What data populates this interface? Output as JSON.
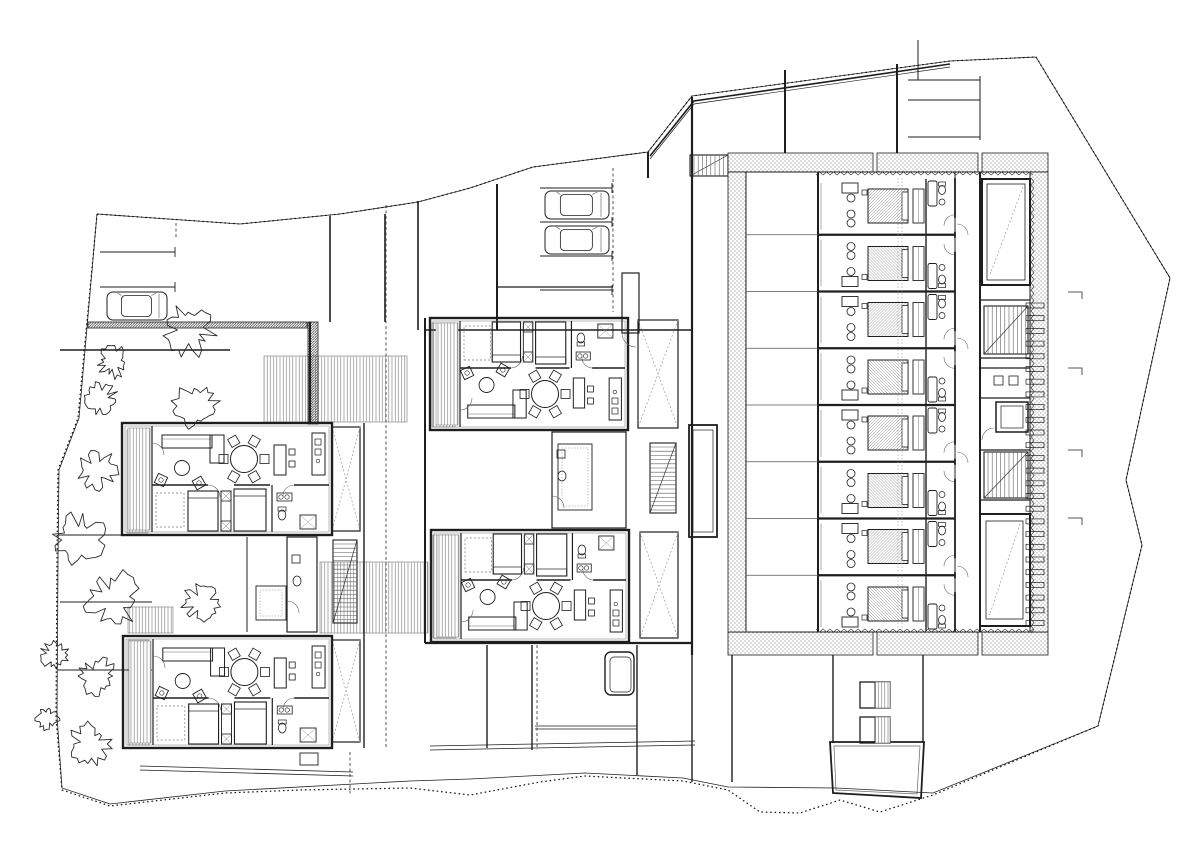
{
  "meta": {
    "title": "architectural ground-floor site plan",
    "drawing_type": "black and white CAD line drawing, no text labels",
    "canvas": {
      "w": 1200,
      "h": 848
    },
    "colors": {
      "ink": "#1e1e1e",
      "fine": "#555555",
      "paper": "#ffffff"
    }
  },
  "legend": {
    "hotel_room_modules": 8,
    "apartment_units": 4,
    "cars": 3,
    "trees": 12,
    "pools": 2,
    "stair_runs": 5,
    "stair_voids": 4
  },
  "boundary": {
    "dotted": [
      [
        97,
        214
      ],
      [
        240,
        224
      ],
      [
        340,
        214
      ],
      [
        418,
        202
      ],
      [
        470,
        188
      ],
      [
        533,
        167
      ],
      [
        648,
        152
      ],
      [
        692,
        96
      ],
      [
        950,
        61
      ],
      [
        1036,
        57
      ],
      [
        1170,
        278
      ],
      [
        1126,
        480
      ],
      [
        1142,
        545
      ],
      [
        1098,
        726
      ],
      [
        933,
        795
      ],
      [
        880,
        812
      ],
      [
        840,
        800
      ],
      [
        800,
        813
      ],
      [
        760,
        812
      ],
      [
        728,
        790
      ],
      [
        683,
        781
      ],
      [
        585,
        776
      ],
      [
        540,
        782
      ],
      [
        470,
        795
      ],
      [
        410,
        788
      ],
      [
        300,
        790
      ],
      [
        225,
        793
      ],
      [
        110,
        806
      ],
      [
        62,
        790
      ],
      [
        56,
        718
      ],
      [
        57,
        560
      ],
      [
        58,
        470
      ],
      [
        78,
        418
      ],
      [
        97,
        214
      ]
    ],
    "solid": [
      [
        97,
        214
      ],
      [
        240,
        224
      ],
      [
        340,
        214
      ],
      [
        418,
        202
      ],
      [
        470,
        188
      ],
      [
        533,
        167
      ],
      [
        648,
        152
      ],
      [
        692,
        96
      ],
      [
        950,
        61
      ],
      [
        1036,
        57
      ],
      [
        1170,
        278
      ],
      [
        1126,
        480
      ],
      [
        1142,
        545
      ],
      [
        1098,
        726
      ],
      [
        933,
        793
      ],
      [
        836,
        788
      ],
      [
        728,
        787
      ],
      [
        683,
        778
      ],
      [
        585,
        773
      ],
      [
        470,
        779
      ],
      [
        410,
        781
      ],
      [
        225,
        791
      ],
      [
        110,
        804
      ],
      [
        62,
        788
      ],
      [
        57,
        716
      ],
      [
        58,
        560
      ],
      [
        59,
        470
      ],
      [
        79,
        418
      ],
      [
        97,
        214
      ]
    ],
    "canopy": [
      [
        650,
        156
      ],
      [
        694,
        101
      ],
      [
        950,
        64
      ]
    ]
  },
  "walls": [
    [
      692,
      97,
      692,
      330,
      2.2
    ],
    [
      692,
      330,
      692,
      655,
      2.2
    ],
    [
      692,
      655,
      692,
      782,
      1.4
    ],
    [
      648,
      152,
      648,
      178,
      2
    ],
    [
      785,
      70,
      785,
      153,
      2
    ],
    [
      897,
      64,
      897,
      153,
      2
    ],
    [
      918,
      40,
      918,
      80,
      1
    ],
    [
      908,
      80,
      980,
      80,
      1
    ],
    [
      908,
      100,
      980,
      100,
      1
    ],
    [
      908,
      137,
      980,
      137,
      1
    ],
    [
      980,
      76,
      980,
      140,
      1
    ],
    [
      330,
      216,
      330,
      322,
      1.6
    ],
    [
      385,
      214,
      385,
      322,
      1.6
    ],
    [
      418,
      201,
      418,
      330,
      1.6
    ],
    [
      310,
      322,
      310,
      424,
      2
    ],
    [
      60,
      350,
      230,
      350,
      1.4
    ],
    [
      58,
      535,
      152,
      535,
      1.1
    ],
    [
      60,
      602,
      152,
      602,
      1.1
    ],
    [
      58,
      670,
      152,
      670,
      1.1
    ],
    [
      364,
      423,
      364,
      748,
      1.4
    ],
    [
      425,
      318,
      425,
      643,
      2
    ],
    [
      425,
      330,
      692,
      330,
      1.6
    ],
    [
      497,
      184,
      497,
      330,
      2
    ],
    [
      497,
      287,
      613,
      287,
      1.2
    ],
    [
      425,
      643,
      692,
      643,
      2.2
    ],
    [
      487,
      645,
      487,
      748,
      1.4
    ],
    [
      532,
      645,
      532,
      750,
      1.4
    ],
    [
      637,
      645,
      637,
      775,
      1.4
    ],
    [
      732,
      655,
      732,
      782,
      1.4
    ],
    [
      833,
      655,
      833,
      743,
      1.4
    ],
    [
      923,
      655,
      923,
      743,
      1.4
    ],
    [
      247,
      537,
      247,
      632,
      1
    ]
  ],
  "double_paths": [
    [
      430,
      746,
      695,
      741
    ],
    [
      430,
      750,
      695,
      745
    ],
    [
      140,
      766,
      353,
      772
    ],
    [
      140,
      770,
      353,
      776
    ],
    [
      535,
      726,
      637,
      726
    ],
    [
      535,
      729,
      637,
      729
    ]
  ],
  "dashed_lines": [
    [
      613,
      168,
      613,
      312
    ],
    [
      386,
      205,
      386,
      748
    ],
    [
      350,
      752,
      350,
      795
    ],
    [
      537,
      645,
      537,
      750
    ],
    [
      176,
      223,
      176,
      237
    ]
  ],
  "decks": [
    [
      264,
      356,
      143,
      66
    ],
    [
      128,
      607,
      45,
      26
    ],
    [
      320,
      562,
      108,
      71
    ],
    [
      127,
      430,
      21,
      103
    ],
    [
      128,
      640,
      21,
      105
    ],
    [
      432,
      323,
      23,
      104
    ],
    [
      433,
      535,
      23,
      103
    ]
  ],
  "hatch_bands": [
    [
      88,
      322,
      219,
      6
    ],
    [
      308,
      322,
      10,
      102
    ]
  ],
  "xvoids": [
    [
      332,
      427,
      28,
      104
    ],
    [
      332,
      640,
      28,
      102
    ],
    [
      638,
      320,
      40,
      108
    ],
    [
      640,
      532,
      38,
      106
    ]
  ],
  "stairs": [
    {
      "x": 333,
      "y": 540,
      "w": 24,
      "h": 83,
      "dir": "v"
    },
    {
      "x": 650,
      "y": 443,
      "w": 26,
      "h": 70,
      "dir": "v"
    },
    {
      "x": 690,
      "y": 155,
      "w": 38,
      "h": 21,
      "dir": "h"
    },
    {
      "x": 984,
      "y": 306,
      "w": 44,
      "h": 48,
      "dir": "h"
    },
    {
      "x": 984,
      "y": 452,
      "w": 44,
      "h": 46,
      "dir": "h"
    }
  ],
  "apartments": [
    {
      "x": 122,
      "y": 423,
      "w": 210,
      "h": 112,
      "flip": false
    },
    {
      "x": 123,
      "y": 636,
      "w": 209,
      "h": 112,
      "flip": false
    },
    {
      "x": 430,
      "y": 318,
      "w": 198,
      "h": 112,
      "flip": true
    },
    {
      "x": 431,
      "y": 530,
      "w": 198,
      "h": 112,
      "flip": true
    }
  ],
  "service_rooms": [
    {
      "x": 287,
      "y": 537,
      "w": 30,
      "h": 95,
      "store": [
        256,
        586,
        30,
        34
      ]
    },
    {
      "x": 552,
      "y": 432,
      "w": 74,
      "h": 96,
      "store": [
        558,
        444,
        34,
        66
      ]
    }
  ],
  "hotel": {
    "bands": [
      [
        728,
        153,
        145,
        19
      ],
      [
        877,
        153,
        101,
        19
      ],
      [
        982,
        153,
        66,
        19
      ],
      [
        728,
        632,
        145,
        23
      ],
      [
        877,
        632,
        101,
        23
      ],
      [
        982,
        632,
        66,
        23
      ],
      [
        728,
        172,
        18,
        460
      ],
      [
        1030,
        172,
        18,
        460
      ]
    ],
    "courtyard": [
      746,
      172,
      284,
      460
    ],
    "terrace": {
      "x1": 746,
      "x2": 818,
      "front_wall_x": 818
    },
    "modules": {
      "x": 818,
      "w": 137,
      "y0": 178,
      "h": 56.75,
      "count": 8
    },
    "corridor": {
      "x1": 955,
      "x2": 980,
      "arc_ys": [
        235,
        349,
        463,
        577
      ]
    },
    "joint_x": [
      898,
      902
    ],
    "pool1": {
      "outer": [
        982,
        179,
        48,
        106
      ],
      "inner": [
        987,
        184,
        38,
        96
      ],
      "diag": [
        1023,
        187,
        991,
        272
      ]
    },
    "pool2": {
      "outer": [
        980,
        514,
        50,
        112
      ],
      "inner": [
        986,
        521,
        37,
        98
      ],
      "diag": [
        1020,
        524,
        990,
        614
      ]
    },
    "wc_room": {
      "wall_ys": [
        300,
        358,
        368,
        398,
        450,
        500
      ],
      "squares": [
        [
          994,
          376,
          9,
          9
        ],
        [
          1009,
          376,
          9,
          9
        ]
      ]
    },
    "elevator": {
      "outer": [
        996,
        402,
        32,
        30
      ],
      "inner": [
        1001,
        406,
        22,
        22
      ]
    },
    "planter": {
      "outer": [
        689,
        425,
        28,
        112
      ],
      "inner": [
        693,
        430,
        20,
        102
      ]
    },
    "fins": {
      "x": 1026,
      "w": 18,
      "h": 5,
      "y0": 303,
      "step": 12.7,
      "count": 26
    },
    "sawtooth": {
      "top_y": 175,
      "bot_y": 629,
      "x1": 816,
      "x2": 1030,
      "right_x": 1031,
      "ry1": 178,
      "ry2": 630
    }
  },
  "parking": {
    "left": {
      "dividers": [
        [
          100,
          252,
          175
        ],
        [
          100,
          287,
          175
        ]
      ],
      "tick_x": 175
    },
    "center": {
      "dividers": [
        [
          540,
          188,
          612
        ],
        [
          540,
          222,
          612
        ],
        [
          540,
          256,
          612
        ],
        [
          540,
          290,
          612
        ]
      ],
      "shaft": [
        622,
        273,
        17,
        60
      ]
    }
  },
  "cars": [
    [
      107,
      292,
      60,
      28
    ],
    [
      545,
      191,
      64,
      28
    ],
    [
      545,
      226,
      64,
      28
    ]
  ],
  "trees": [
    [
      190,
      330,
      27
    ],
    [
      113,
      362,
      17
    ],
    [
      196,
      406,
      24
    ],
    [
      101,
      399,
      17
    ],
    [
      97,
      470,
      22
    ],
    [
      80,
      540,
      28
    ],
    [
      113,
      600,
      30
    ],
    [
      202,
      603,
      21
    ],
    [
      97,
      676,
      20
    ],
    [
      55,
      655,
      15
    ],
    [
      90,
      744,
      22
    ],
    [
      48,
      718,
      13
    ]
  ],
  "pads": {
    "round_pad": {
      "outer": [
        605,
        652,
        29,
        43
      ],
      "inner": [
        610,
        657,
        21,
        35
      ]
    },
    "small_rect": [
      300,
      753,
      18,
      12
    ],
    "trapezoid": [
      [
        830,
        742
      ],
      [
        924,
        742
      ],
      [
        921,
        798
      ],
      [
        833,
        793
      ]
    ],
    "trapezoid_inner": [
      [
        834,
        746
      ],
      [
        920,
        746
      ],
      [
        917,
        794
      ],
      [
        836,
        790
      ]
    ]
  },
  "vents": [
    [
      860,
      682,
      30,
      26
    ],
    [
      860,
      717,
      30,
      26
    ]
  ],
  "corner_ticks": [
    [
      1068,
      292
    ],
    [
      1068,
      368
    ],
    [
      1068,
      450
    ],
    [
      1068,
      518
    ]
  ]
}
